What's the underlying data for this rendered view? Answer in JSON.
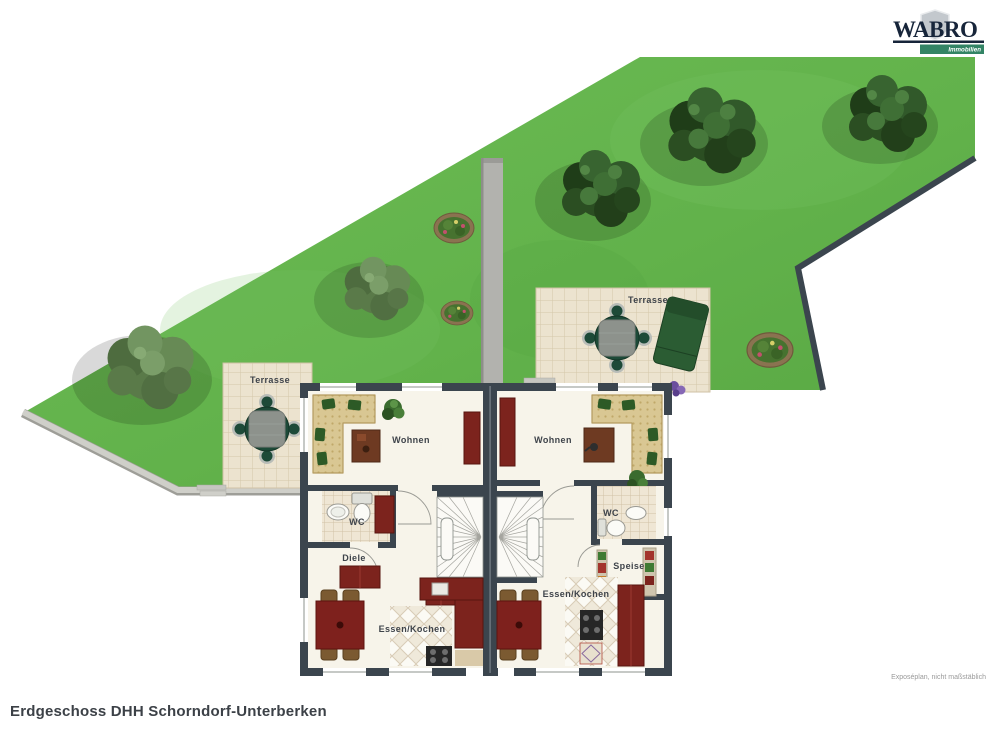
{
  "logo": {
    "brand": "WABRO",
    "tagline": "Immobilien"
  },
  "title": "Erdgeschoss DHH Schorndorf-Unterberken",
  "footnote": "Exposéplan, nicht maßstäblich",
  "plan": {
    "left_unit": {
      "terrace": "Terrasse",
      "living": "Wohnen",
      "wc": "WC",
      "hall": "Diele",
      "kitchen": "Essen/Kochen"
    },
    "right_unit": {
      "terrace": "Terrasse",
      "living": "Wohnen",
      "wc": "WC",
      "pantry": "Speise",
      "kitchen": "Essen/Kochen"
    }
  },
  "colors": {
    "grass": "#63b34c",
    "wall": "#3b454e",
    "floor": "#f7f4ea",
    "terrace_tile": "#ece3cf",
    "furniture_red": "#7c231d",
    "terrace_furniture_green": "#1d4a38",
    "path_gray": "#b2b2ae",
    "logo_green": "#338465",
    "logo_navy": "#17253a"
  }
}
